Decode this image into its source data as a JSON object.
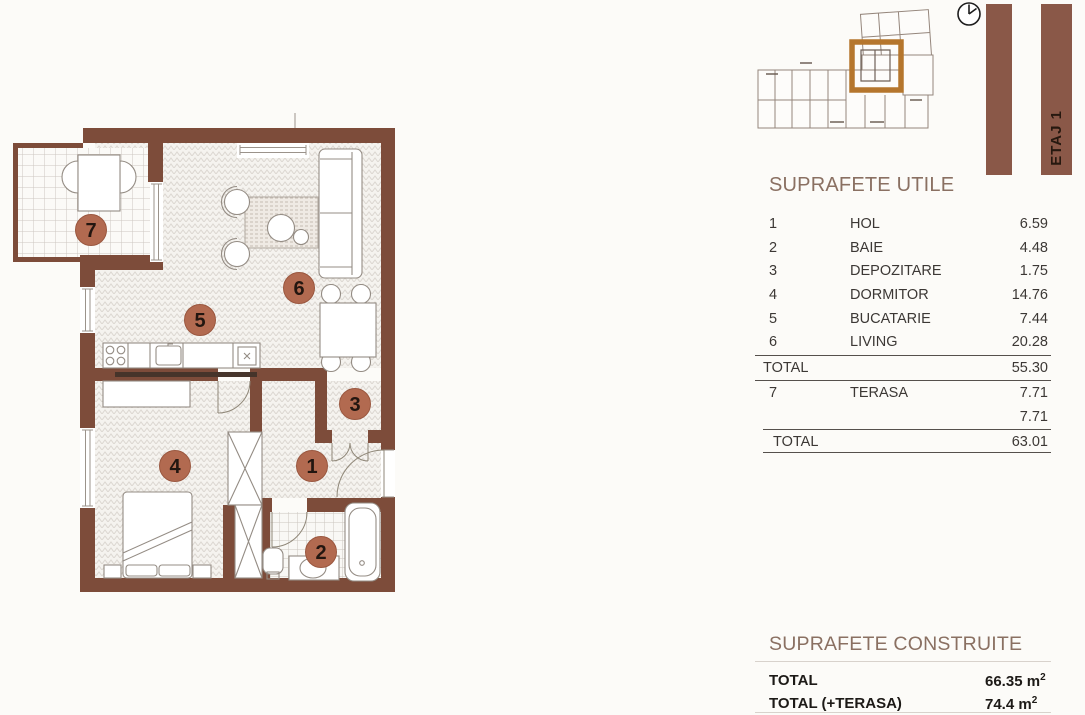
{
  "key_plan": {
    "floor_label": "ETAJ 1"
  },
  "plan_labels": {
    "hol": "1",
    "baie": "2",
    "depozitare": "3",
    "dormitor": "4",
    "bucatarie": "5",
    "living": "6",
    "terasa": "7"
  },
  "utile": {
    "title": "SUPRAFETE UTILE",
    "rows": [
      {
        "num": "1",
        "name": "HOL",
        "value": "6.59"
      },
      {
        "num": "2",
        "name": "BAIE",
        "value": "4.48"
      },
      {
        "num": "3",
        "name": "DEPOZITARE",
        "value": "1.75"
      },
      {
        "num": "4",
        "name": "DORMITOR",
        "value": "14.76"
      },
      {
        "num": "5",
        "name": "BUCATARIE",
        "value": "7.44"
      },
      {
        "num": "6",
        "name": "LIVING",
        "value": "20.28"
      }
    ],
    "total_label": "TOTAL",
    "total_value": "55.30",
    "terasa": {
      "num": "7",
      "name": "TERASA",
      "value": "7.71"
    },
    "terasa_second_value": "7.71",
    "grand_total_label": "TOTAL",
    "grand_total_value": "63.01"
  },
  "construite": {
    "title": "SUPRAFETE CONSTRUITE",
    "total": {
      "label": "TOTAL",
      "value": "66.35",
      "unit": "m",
      "sup": "2"
    },
    "total_terasa": {
      "label": "TOTAL (+TERASA)",
      "value": "74.4",
      "unit": "m",
      "sup": "2"
    }
  },
  "colors": {
    "wall": "#7d4c3a",
    "room_badge": "#b26a50",
    "unit_highlight": "#b5762d",
    "floor_bar": "#8a5848",
    "title_text": "#8a7062"
  }
}
